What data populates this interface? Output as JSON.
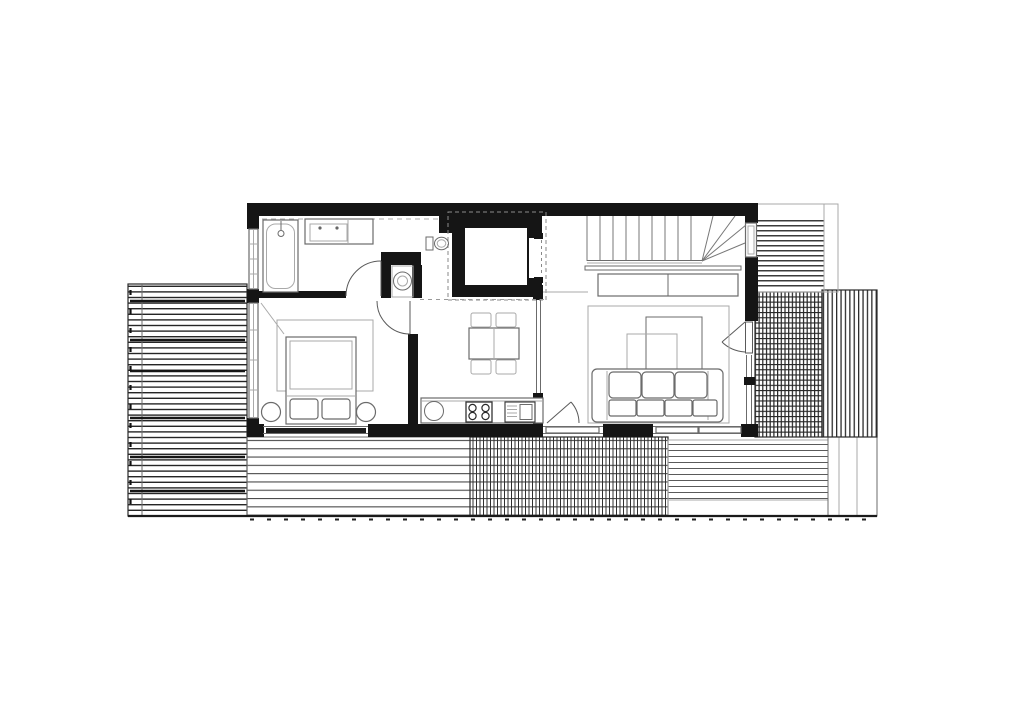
{
  "title": "Upper-floor architectural plan of a house with wrap-around timber decks",
  "colors": {
    "background": "#ffffff",
    "wall": "#151515",
    "line_dark": "#2a2a2a",
    "line_mid": "#6b6b6b",
    "line_light": "#a9a9a9",
    "deck_line": "#262626"
  },
  "plan": {
    "rooms": [
      {
        "id": "bathroom",
        "label": "Bathroom",
        "fixtures": [
          "bathtub",
          "shower-mixer",
          "double-basin-vanity",
          "toilet",
          "washing-machine-closet",
          "hinged-door"
        ]
      },
      {
        "id": "bedroom",
        "label": "Bedroom",
        "fixtures": [
          "double-bed",
          "duvet",
          "two-pillows",
          "area-rug",
          "round-stool-left",
          "round-stool-right",
          "sliding-door-to-deck",
          "casement-window"
        ]
      },
      {
        "id": "stair-hall",
        "label": "Stair hall",
        "fixtures": [
          "staircase-with-winder-treads",
          "railing",
          "elevator-shaft",
          "under-stair-cabinet",
          "window"
        ]
      },
      {
        "id": "kitchen-dining",
        "label": "Kitchen / dining",
        "fixtures": [
          "dining-table",
          "four-chairs",
          "round-sink",
          "four-burner-cooktop",
          "sink-unit",
          "kitchen-counter",
          "glass-partition"
        ]
      },
      {
        "id": "living-room",
        "label": "Living room",
        "fixtures": [
          "sofa",
          "two-overlapping-coffee-tables",
          "area-rug",
          "hinged-door-to-bottom-deck",
          "hinged-door-to-right-deck",
          "sliding-glazing",
          "fixed-glazing"
        ]
      }
    ],
    "outdoor_areas": [
      {
        "id": "left-deck",
        "pattern": "dense horizontal decking boards"
      },
      {
        "id": "bottom-deck-west",
        "pattern": "wide horizontal decking boards"
      },
      {
        "id": "bottom-deck-center",
        "pattern": "cross-hatched grating"
      },
      {
        "id": "bottom-deck-east",
        "pattern": "horizontal decking boards"
      },
      {
        "id": "bottom-deck-corner",
        "pattern": "plain with joint lines"
      },
      {
        "id": "right-deck-grating",
        "pattern": "cross-hatched grating"
      },
      {
        "id": "right-deck-slats",
        "pattern": "vertical slats"
      },
      {
        "id": "top-right-deck",
        "pattern": "horizontal decking boards"
      }
    ]
  }
}
